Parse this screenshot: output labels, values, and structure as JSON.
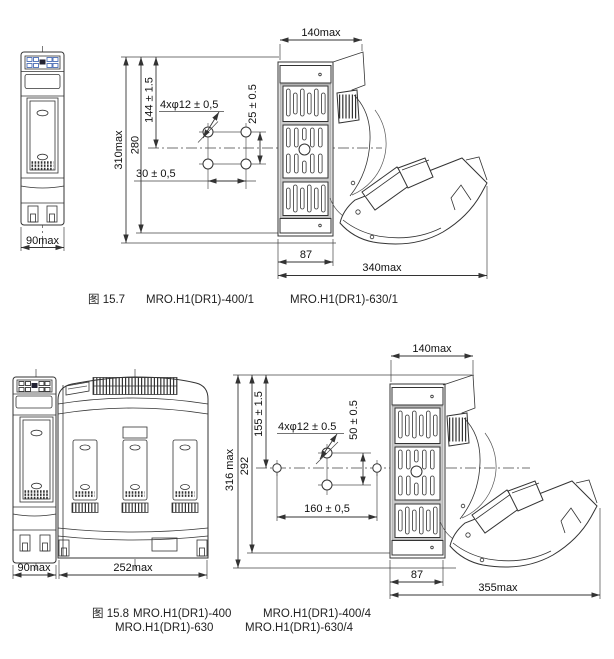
{
  "page": {
    "bg": "#ffffff",
    "line_color": "#333333",
    "text_color": "#111111",
    "label_accent_blue": "#4a6db5"
  },
  "figure_top": {
    "fig_label": "图 15.7",
    "models": [
      "MRO.H1(DR1)-400/1",
      "MRO.H1(DR1)-630/1"
    ],
    "dims": {
      "front_width": "90max",
      "top_width": "140max",
      "overall_height": "310max",
      "body_height": "280",
      "hole_offset_top": "144 ± 1.5",
      "hole_note": "4xφ12 ± 0,5",
      "hole_pitch_v": "25 ± 0.5",
      "hole_pitch_h": "30 ± 0,5",
      "base_depth": "87",
      "open_depth": "340max"
    }
  },
  "figure_bottom": {
    "fig_label": "图 15.8",
    "models_row1": [
      "MRO.H1(DR1)-400",
      "MRO.H1(DR1)-400/4"
    ],
    "models_row2": [
      "MRO.H1(DR1)-630",
      "MRO.H1(DR1)-630/4"
    ],
    "dims": {
      "side_width": "90max",
      "front_width": "252max",
      "top_width": "140max",
      "overall_height": "316 max",
      "body_height": "292",
      "hole_offset_top": "155 ± 1.5",
      "hole_note": "4xφ12 ± 0.5",
      "hole_pitch_v": "50 ± 0.5",
      "hole_pitch_h": "160 ± 0,5",
      "base_depth": "87",
      "open_depth": "355max"
    }
  }
}
